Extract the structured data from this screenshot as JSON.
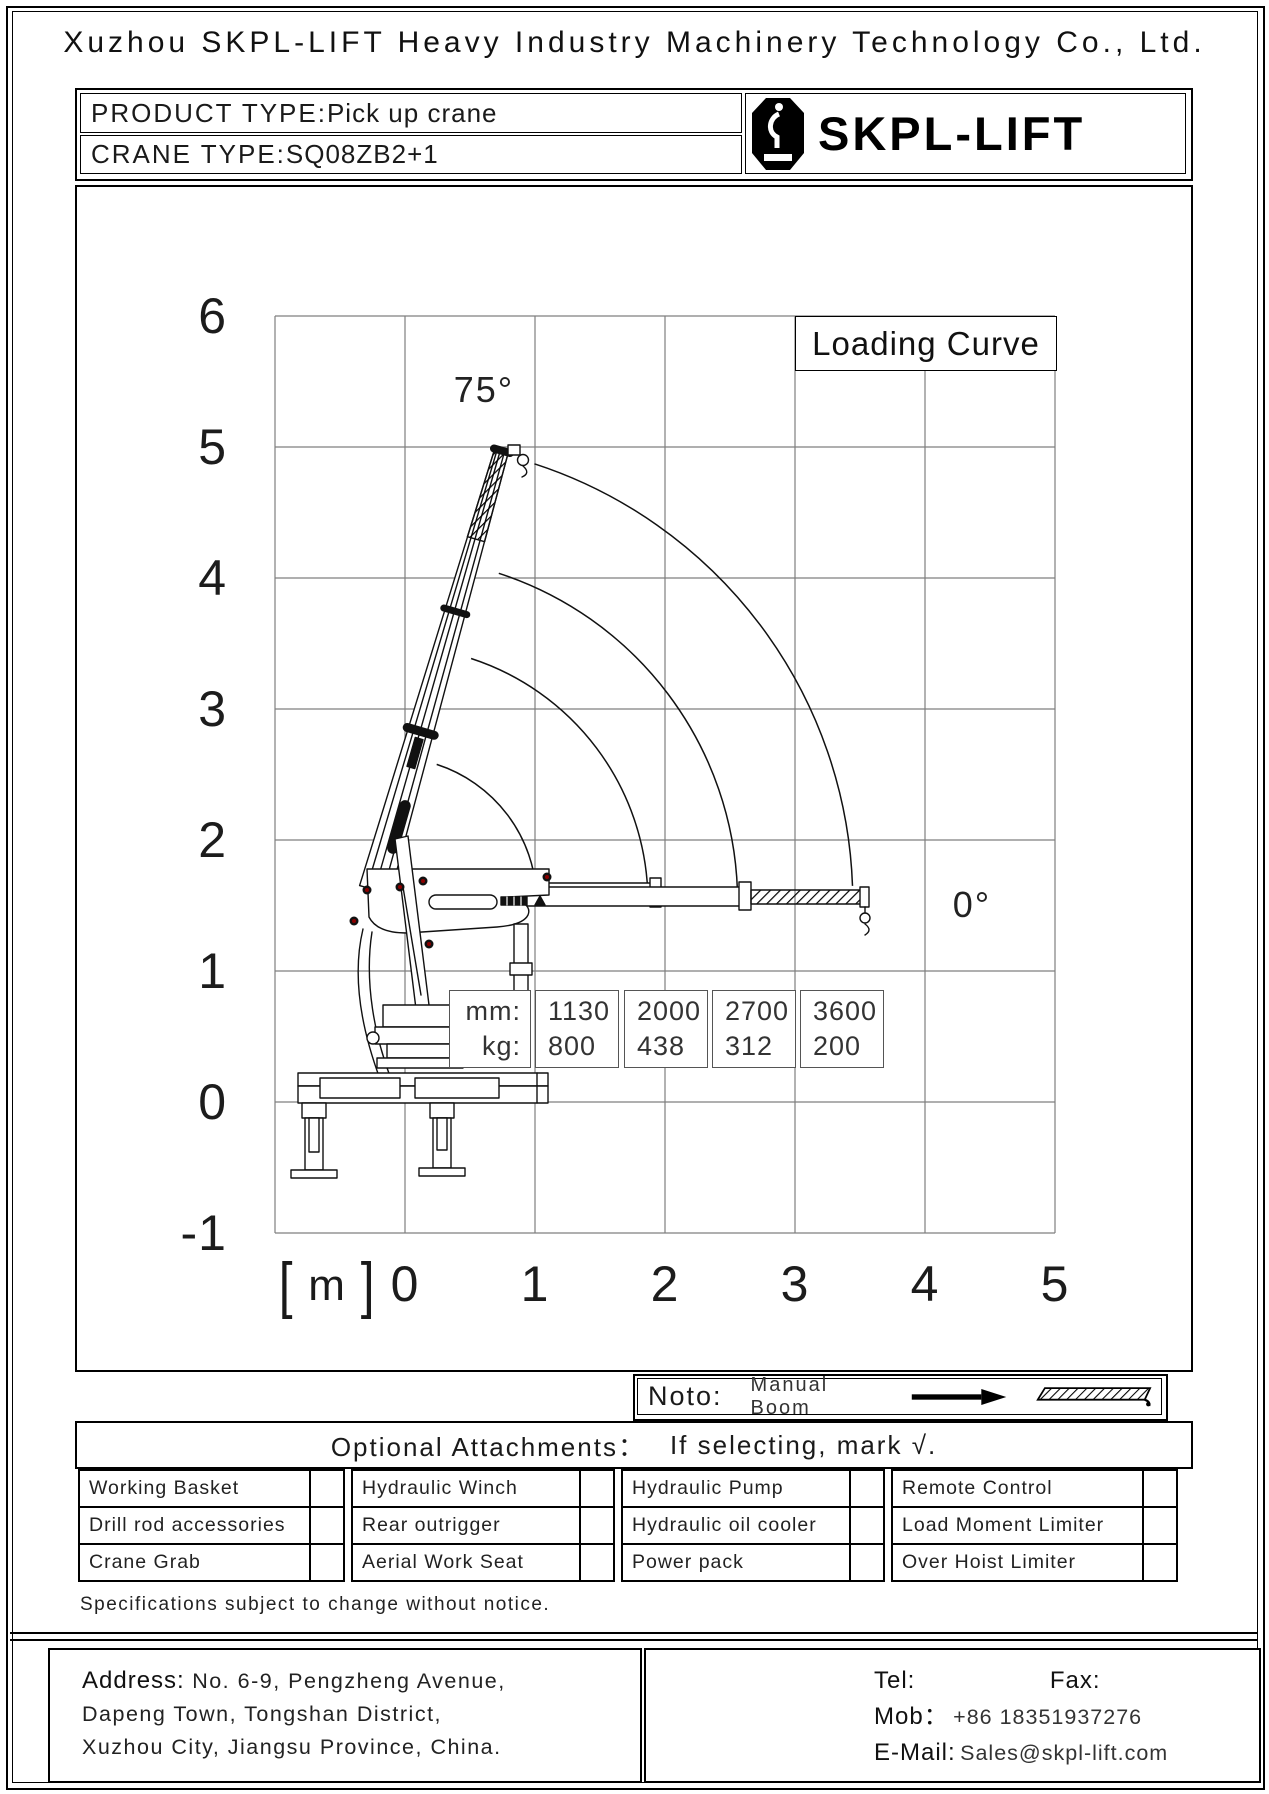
{
  "header": {
    "company_title": "Xuzhou SKPL-LIFT Heavy Industry Machinery Technology Co., Ltd."
  },
  "product_box": {
    "product_type_label": "PRODUCT TYPE:",
    "product_type_value": "Pick up crane",
    "crane_type_label": "CRANE TYPE:",
    "crane_type_value": "SQ08ZB2+1",
    "brand": "SKPL-LIFT"
  },
  "chart_data": {
    "type": "line",
    "title": "Loading Curve",
    "unit": "m",
    "unit_open": "[",
    "unit_close": "]",
    "x_ticks": [
      "0",
      "1",
      "2",
      "3",
      "4",
      "5"
    ],
    "y_ticks": [
      "6",
      "5",
      "4",
      "3",
      "2",
      "1",
      "0",
      "-1"
    ],
    "xlim": [
      -1,
      5
    ],
    "ylim": [
      -1,
      6
    ],
    "grid": true,
    "boom_angle_max": "75°",
    "boom_angle_min": "0°",
    "curves": {
      "description": "boom tip sweep arcs from 75° to 0° at each telescopic extension",
      "radii_m": [
        1.13,
        2.0,
        2.7,
        3.6
      ],
      "extension_mm": [
        1130,
        2000,
        2700,
        3600
      ],
      "capacity_kg": [
        800,
        438,
        312,
        200
      ]
    },
    "load_table": {
      "row_labels": [
        "mm:",
        "kg:"
      ],
      "columns": [
        {
          "mm": "1130",
          "kg": "800"
        },
        {
          "mm": "2000",
          "kg": "438"
        },
        {
          "mm": "2700",
          "kg": "312"
        },
        {
          "mm": "3600",
          "kg": "200"
        }
      ]
    }
  },
  "note": {
    "label": "Noto:",
    "text": "Manual Boom"
  },
  "attachments": {
    "title": "Optional Attachments：",
    "instruction": "If selecting, mark √.",
    "rows": [
      [
        "Working Basket",
        "Hydraulic Winch",
        "Hydraulic Pump",
        "Remote Control"
      ],
      [
        "Drill rod accessories",
        "Rear outrigger",
        "Hydraulic oil cooler",
        "Load Moment Limiter"
      ],
      [
        "Crane Grab",
        "Aerial Work Seat",
        "Power pack",
        "Over Hoist Limiter"
      ]
    ]
  },
  "disclaimer": "Specifications subject to change without notice.",
  "footer": {
    "address_label": "Address:",
    "address_line1": "No. 6-9, Pengzheng Avenue,",
    "address_line2": "Dapeng Town, Tongshan District,",
    "address_line3": "Xuzhou City, Jiangsu Province, China.",
    "tel_label": "Tel:",
    "fax_label": "Fax:",
    "mob_label": "Mob：",
    "mob_value": "+86 18351937276",
    "email_label": "E-Mail:",
    "email_value": "Sales@skpl-lift.com"
  }
}
